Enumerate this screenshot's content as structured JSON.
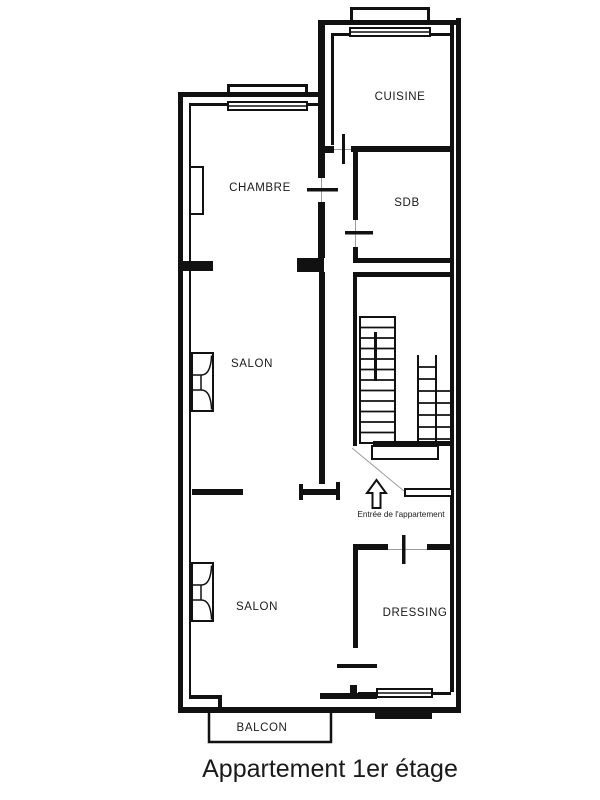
{
  "title": "Appartement 1er étage",
  "rooms": {
    "cuisine": "CUISINE",
    "chambre": "CHAMBRE",
    "sdb": "SDB",
    "salon_upper": "SALON",
    "salon_lower": "SALON",
    "dressing": "DRESSING",
    "balcon": "BALCON"
  },
  "annotations": {
    "entrance": "Entrée de l'appartement"
  },
  "colors": {
    "line": "#111111",
    "door_axis": "#9c9c9c",
    "background": "#ffffff"
  }
}
